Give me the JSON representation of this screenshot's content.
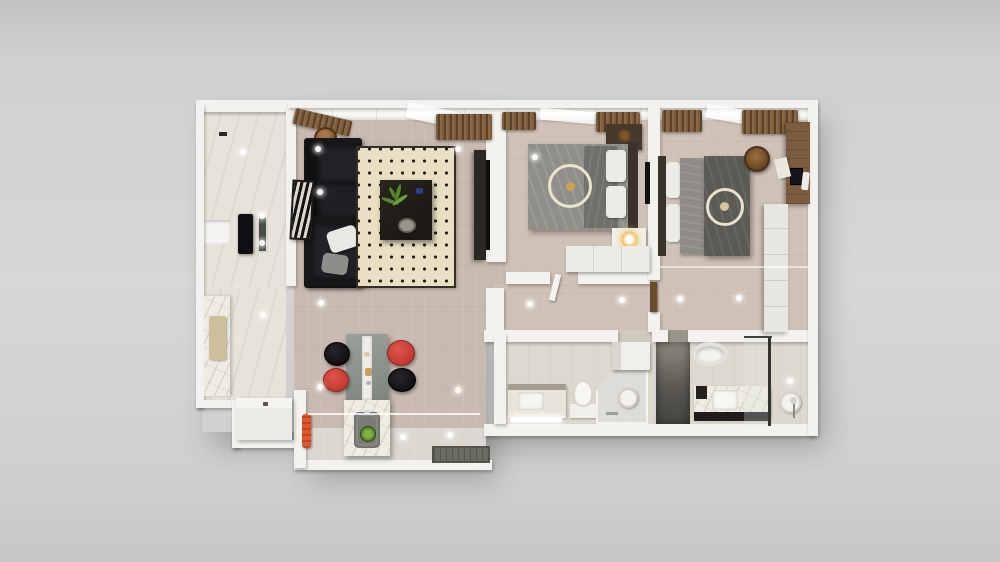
{
  "scene": {
    "title": "Top-down 3D render of a two-bedroom apartment floor plan",
    "rooms": {
      "entry": {
        "label": "Entry hall",
        "features": [
          "wall niche shelf",
          "tall black cabinet",
          "glass door panel"
        ]
      },
      "kitchen": {
        "label": "Kitchen",
        "features": [
          "marble counter",
          "wooden cutting board",
          "white cabinet block",
          "orange towel"
        ]
      },
      "living": {
        "label": "Living room",
        "features": [
          "black leather corner sofa",
          "white pillow",
          "grey pillow",
          "cream rug with black dot grid",
          "dark coffee table with green fern plant",
          "zebra-stripe wall art",
          "TV console",
          "woven basket",
          "brown window curtains"
        ]
      },
      "dining": {
        "label": "Dining area",
        "features": [
          "grey dining table with white runner",
          "two red chairs",
          "two black chairs",
          "marble kitchen island with sink and green bowl",
          "dark entrance doormat"
        ]
      },
      "bedroom1": {
        "label": "Bedroom 1",
        "features": [
          "double bed with ring-pattern grey duvet",
          "white pillows",
          "dark headboard",
          "glowing bedside lamp",
          "white dresser",
          "wall TV",
          "dark wardrobe with bowl"
        ]
      },
      "bedroom2": {
        "label": "Bedroom 2",
        "features": [
          "double bed with ring-pattern dark duvet",
          "brown round chair",
          "wooden desk with laptop and papers",
          "white wardrobe"
        ]
      },
      "corridor": {
        "label": "Hallway",
        "features": [
          "open doors to bedrooms and bathrooms"
        ]
      },
      "bathroom1": {
        "label": "Bathroom 1",
        "features": [
          "vanity with lit shelf",
          "toilet",
          "corner glass shower",
          "round mirror",
          "washing machine"
        ]
      },
      "bathroom2": {
        "label": "Bathroom 2",
        "features": [
          "bathtub",
          "marble vanity with black base",
          "glass shower partition",
          "round mirror",
          "shower fixture"
        ]
      }
    },
    "lights": [
      {
        "x": 243,
        "y": 152
      },
      {
        "x": 262,
        "y": 216
      },
      {
        "x": 262,
        "y": 243
      },
      {
        "x": 318,
        "y": 149
      },
      {
        "x": 320,
        "y": 192
      },
      {
        "x": 458,
        "y": 149
      },
      {
        "x": 263,
        "y": 315
      },
      {
        "x": 321,
        "y": 303
      },
      {
        "x": 320,
        "y": 387
      },
      {
        "x": 403,
        "y": 437
      },
      {
        "x": 450,
        "y": 435
      },
      {
        "x": 458,
        "y": 390
      },
      {
        "x": 535,
        "y": 157
      },
      {
        "x": 530,
        "y": 304
      },
      {
        "x": 622,
        "y": 300
      },
      {
        "x": 680,
        "y": 299
      },
      {
        "x": 739,
        "y": 298
      },
      {
        "x": 790,
        "y": 381
      }
    ]
  },
  "palette": {
    "bg_top": "#c2c2c2",
    "bg_mid": "#d7d7d7",
    "wall": "#f3f2ee",
    "wood": "#c8bab0",
    "wood_bed": "#cfc1b6",
    "tile": "#e7e3da",
    "bath": "#ded9cf",
    "rug": "#e9dfc2",
    "rug_border": "#352e25",
    "sofa": "#17171a",
    "red_chair": "#c03830",
    "towel": "#e2572e",
    "curtain_a": "#7c5d3d",
    "curtain_b": "#5b402a",
    "duvet_light": "#908e88",
    "duvet_dark": "#5b5a55",
    "blanket_1": "#6f6e68",
    "blanket_2": "#8d8b84",
    "ring_cream": "#ece4cc",
    "gold": "#c9a258",
    "marble": "#efece4",
    "plant_green": "#5a8531",
    "desk_wood": "#7c5c3e",
    "mat_grey": "#6c6b62",
    "dark_unit": "#101014",
    "headboard": "#3b332b",
    "glow": "#f0c469"
  }
}
